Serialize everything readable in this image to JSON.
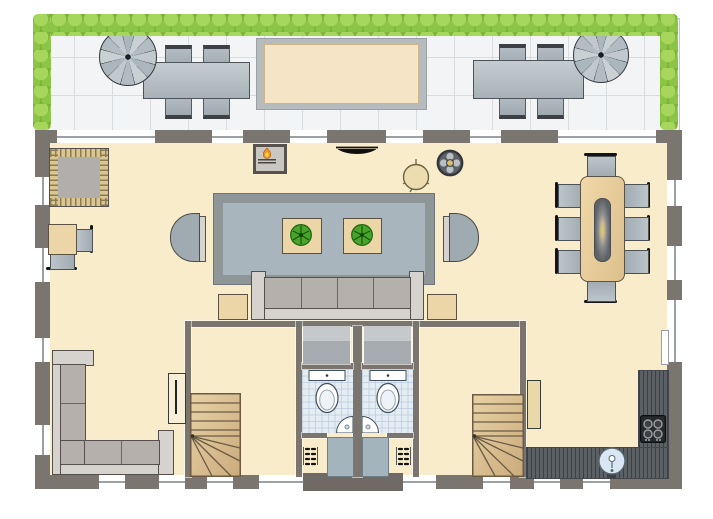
{
  "meta": {
    "kind": "architectural floor plan drawing",
    "visible_text": "none"
  },
  "palette": {
    "wall": "#7b7570",
    "floor_cream": "#f9ecca",
    "terrace_tile": "#f3f4f6",
    "tile_line": "#d9dcdf",
    "hedge_green": "#8cc446",
    "hedge_light": "#a6d65c",
    "skylight_frame": "#b6bbbe",
    "skylight_inner": "#f6e4c6",
    "steel_gray": "#b2bcc2",
    "wood_light": "#ecd5a6",
    "stair_wood": "#d9c197",
    "rug_gray": "#a9b5bc",
    "sofa_gray": "#b5b0ac",
    "frame_light": "#d6d3cf",
    "kitchen_counter": "#5b6064",
    "water_blue": "#d8e7f3",
    "bath_tile": "#e4ecf4",
    "flame_orange": "#f29422",
    "plant_green": "#4aa32c",
    "lamp_glow": "#e8c95e"
  },
  "areas": {
    "roof_terrace": {
      "features": [
        "hedge-top",
        "hedge-left",
        "hedge-right",
        "tiled-floor",
        "skylight",
        "spiral-staircase-left",
        "spiral-staircase-right",
        "outdoor-table-left",
        "outdoor-table-right"
      ],
      "chairs_per_table": 4
    },
    "living_room": {
      "features": [
        "area-rug",
        "three-seat-sofa",
        "armchair-left",
        "armchair-right",
        "plant-table-left",
        "plant-table-right",
        "side-table-left",
        "side-table-right",
        "fireplace",
        "wall-tv",
        "stool",
        "round-heater"
      ]
    },
    "study_corner": {
      "features": [
        "fringed-rug",
        "desk",
        "desk-chair",
        "side-chair"
      ]
    },
    "dining_area": {
      "features": [
        "dining-table",
        "table-lamp"
      ],
      "chairs": 8
    },
    "lounge_corner": {
      "features": [
        "corner-sofa",
        "radiator"
      ]
    },
    "bathrooms": {
      "count": 2,
      "features_each": [
        "closet",
        "toilet",
        "corner-sink",
        "door",
        "entry-steps"
      ]
    },
    "staircases": {
      "count": 2,
      "type": "winder"
    },
    "kitchen": {
      "features": [
        "l-shaped-counter",
        "cooktop-4-burners",
        "round-sink",
        "tall-cabinet"
      ]
    },
    "entrance": {
      "features": [
        "front-porch"
      ]
    }
  }
}
